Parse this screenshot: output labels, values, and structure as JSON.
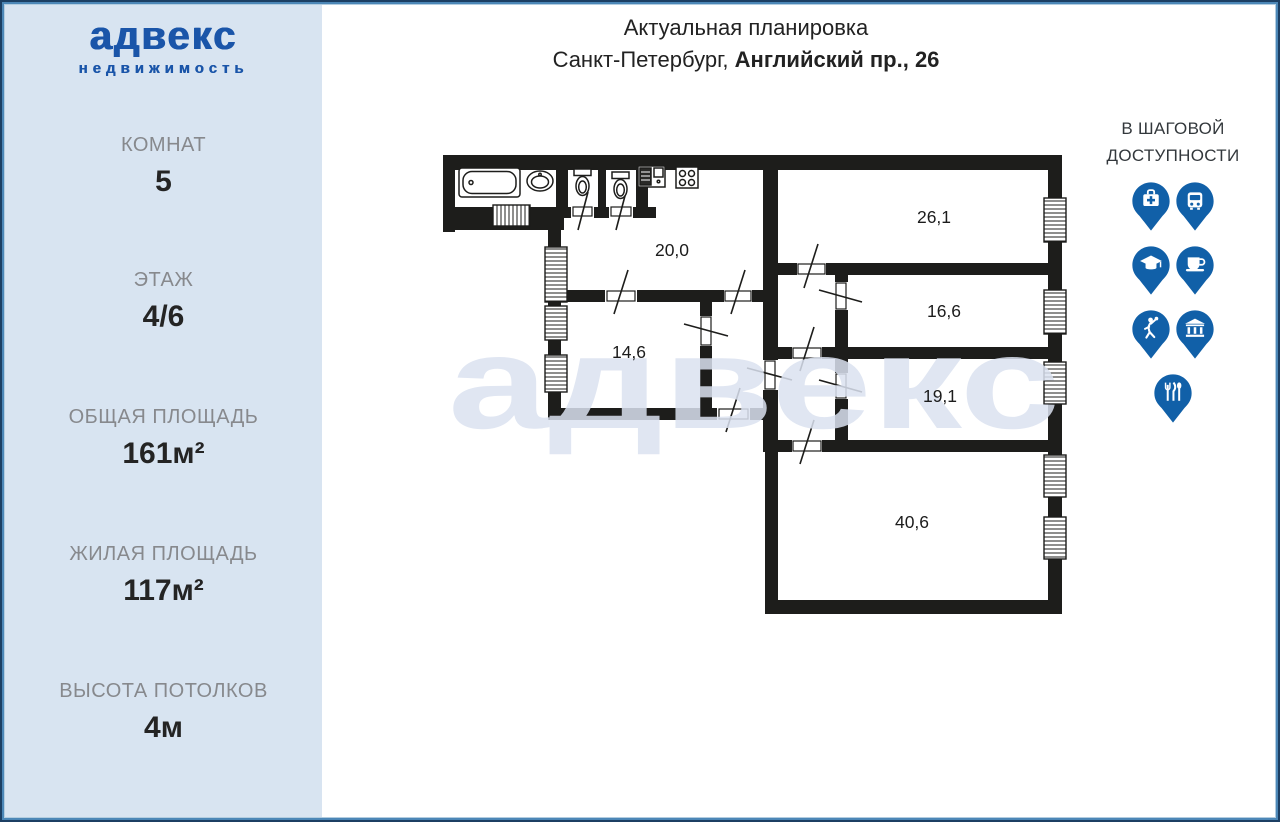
{
  "logo": {
    "name": "адвекс",
    "subtitle": "недвижимость"
  },
  "title": {
    "line1": "Актуальная планировка",
    "city": "Санкт-Петербург, ",
    "address": "Английский пр., 26"
  },
  "stats": [
    {
      "label": "КОМНАТ",
      "value": "5"
    },
    {
      "label": "ЭТАЖ",
      "value": "4/6"
    },
    {
      "label": "ОБЩАЯ ПЛОЩАДЬ",
      "value": "161м²"
    },
    {
      "label": "ЖИЛАЯ ПЛОЩАДЬ",
      "value": "117м²"
    },
    {
      "label": "ВЫСОТА ПОТОЛКОВ",
      "value": "4м"
    }
  ],
  "walkability": {
    "heading_line1": "В ШАГОВОЙ",
    "heading_line2": "ДОСТУПНОСТИ",
    "rows": [
      [
        "medical-icon",
        "bus-icon"
      ],
      [
        "education-icon",
        "cafe-icon"
      ],
      [
        "sport-icon",
        "bank-icon"
      ],
      [
        "restaurant-icon"
      ]
    ]
  },
  "floor_plan": {
    "watermark": "адвекс",
    "rooms": [
      {
        "name": "kitchen",
        "area": "20,0"
      },
      {
        "name": "room-top-right",
        "area": "26,1"
      },
      {
        "name": "room-right-middle",
        "area": "16,6"
      },
      {
        "name": "room-right-lower",
        "area": "19,1"
      },
      {
        "name": "room-bottom",
        "area": "40,6"
      },
      {
        "name": "room-left",
        "area": "14,6"
      }
    ]
  },
  "colors": {
    "brand_blue": "#1a55a9",
    "pin_blue": "#1160a8",
    "sidebar_bg": "#d8e4f1",
    "wall_black": "#1d1d1b",
    "watermark": "#dbe2f0",
    "label_gray": "#87898d"
  }
}
